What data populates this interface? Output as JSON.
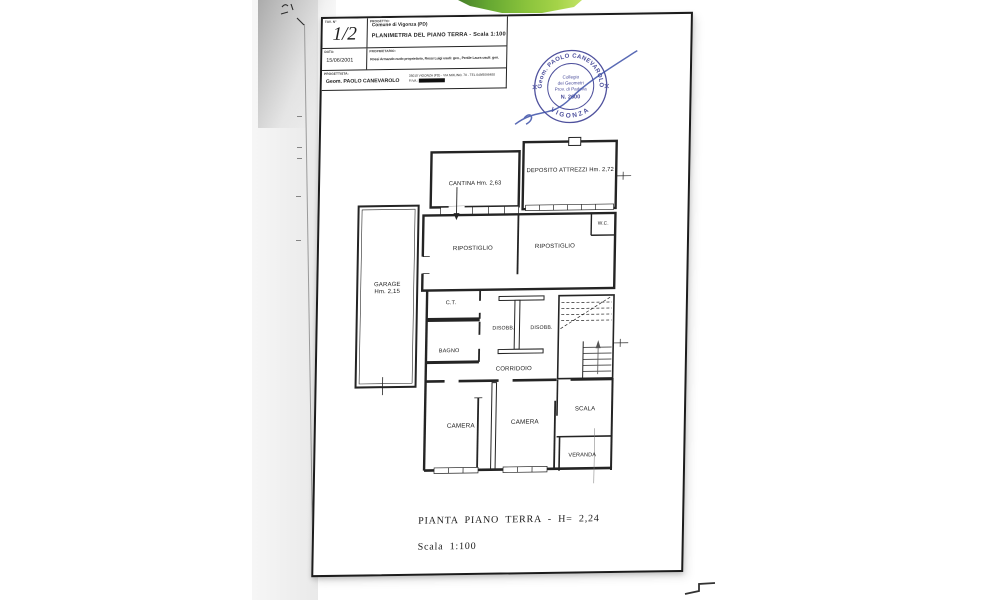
{
  "title_block": {
    "sheet_no_label": "TAV. N°",
    "sheet_no": "1/2",
    "progetto_label": "PROGETTO:",
    "progetto_line1": "Comune di Vigonza (PD)",
    "progetto_line2": "PLANIMETRIA DEL PIANO TERRA - Scala 1:100",
    "data_label": "DATA:",
    "data_value": "15/06/2001",
    "proprietario_label": "PROPRIETARIO:",
    "proprietario_value": "Rossi Armando nudo proprietario, Rossi Luigi usufr. gen., Pertile Laura usufr. gen.",
    "progettista_label": "PROGETTISTA:",
    "progettista_value": "Geom. PAOLO CANEVAROLO",
    "studio_line1": "35010 VIGONZA (PD) - VIA MOLINO, 70 - TEL 049/8096488",
    "studio_line2": "P.IVA :"
  },
  "stamp": {
    "arc_top": "Geom. PAOLO CANEVAROLO",
    "arc_bottom": "VIGONZA",
    "line1": "Collegio",
    "line2": "dei Geometri",
    "line3": "Prov. di Padova",
    "line4": "N. 2600",
    "ink_color": "#3c3f93"
  },
  "plan": {
    "garage_line1": "GARAGE",
    "garage_line2": "Hm. 2,15",
    "cantina": "CANTINA Hm. 2,63",
    "deposito": "DEPOSITO ATTREZZI Hm. 2,72",
    "ripostiglio_left": "RIPOSTIGLIO",
    "ripostiglio_right": "RIPOSTIGLIO",
    "wc": "W.C.",
    "ct": "C.T.",
    "disobb_left": "DISOBB.",
    "disobb_right": "DISOBB.",
    "bagno": "BAGNO",
    "corridoio": "CORRIDOIO",
    "camera_left": "CAMERA",
    "camera_right": "CAMERA",
    "scala": "SCALA",
    "veranda": "VERANDA"
  },
  "caption": {
    "line1": "PIANTA PIANO TERRA - H= 2,24",
    "line2": "Scala 1:100"
  }
}
